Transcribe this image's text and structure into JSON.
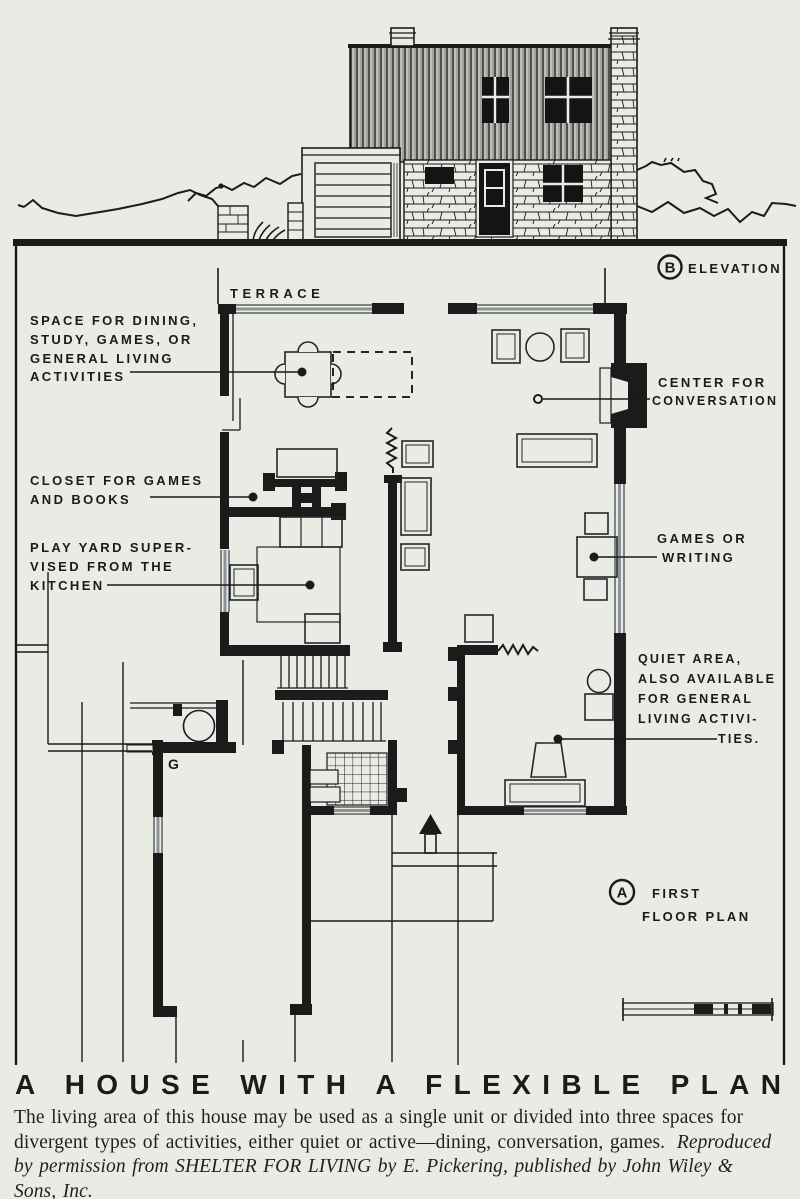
{
  "page": {
    "bg": "#e9ece5",
    "ink": "#1b1b1b"
  },
  "elevation": {
    "tag_letter": "B",
    "tag_label": "ELEVATION"
  },
  "plan": {
    "tag_letter": "A",
    "tag_label_line1": "FIRST",
    "tag_label_line2": "FLOOR PLAN",
    "terrace_label": "TERRACE",
    "garage_label": "G",
    "annotations": {
      "dining": {
        "lines": [
          "SPACE FOR DINING,",
          "STUDY, GAMES, OR",
          "GENERAL LIVING",
          "ACTIVITIES"
        ]
      },
      "closet": {
        "lines": [
          "CLOSET FOR GAMES",
          "AND BOOKS"
        ]
      },
      "play_yard": {
        "lines": [
          "PLAY YARD SUPER-",
          "VISED FROM THE",
          "KITCHEN"
        ]
      },
      "conversation": {
        "lines": [
          "CENTER FOR",
          "CONVERSATION"
        ]
      },
      "games": {
        "lines": [
          "GAMES OR",
          "WRITING"
        ]
      },
      "quiet": {
        "lines": [
          "QUIET AREA,",
          "ALSO AVAILABLE",
          "FOR GENERAL",
          "LIVING ACTIVI-",
          "TIES."
        ]
      }
    }
  },
  "title": "A HOUSE WITH A FLEXIBLE PLAN",
  "caption": {
    "line1": "The living area of this house may be used as a single unit or divided into three spaces for",
    "line2_roman": "divergent types of activities, either quiet or active—dining, conversation, games.",
    "line2_italic": "Reproduced",
    "line3_italic": "by permission from SHELTER FOR LIVING by E. Pickering, published by John Wiley &",
    "line4_italic": "Sons, Inc."
  }
}
